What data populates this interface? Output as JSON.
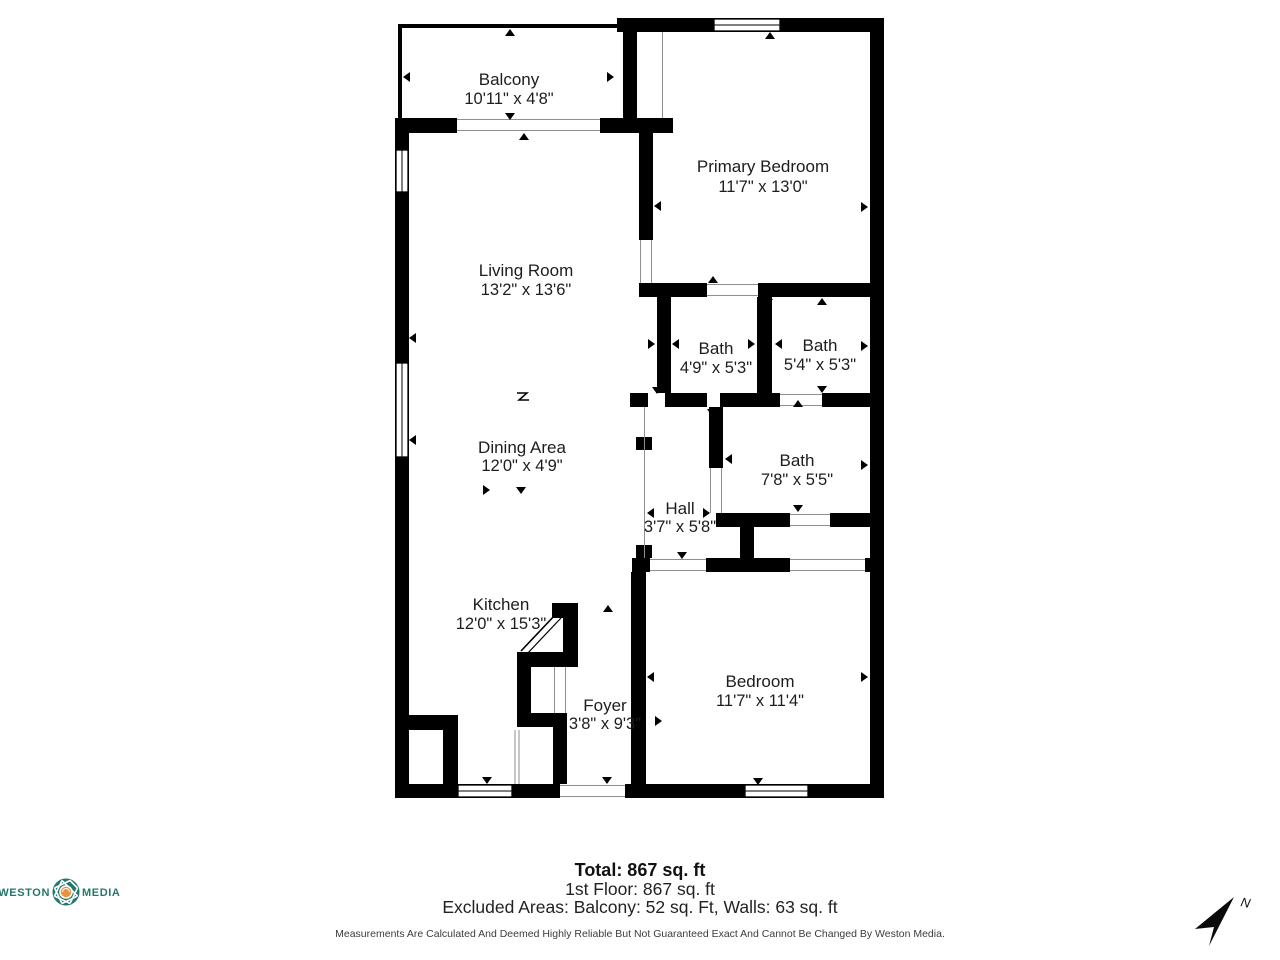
{
  "plan": {
    "rooms": [
      {
        "name": "Balcony",
        "dims": "10'11\" x 4'8\""
      },
      {
        "name": "Primary Bedroom",
        "dims": "11'7\" x 13'0\""
      },
      {
        "name": "Living Room",
        "dims": "13'2\" x 13'6\""
      },
      {
        "name": "Bath",
        "dims": "4'9\" x 5'3\""
      },
      {
        "name": "Bath",
        "dims": "5'4\" x 5'3\""
      },
      {
        "name": "Dining Area",
        "dims": "12'0\" x 4'9\""
      },
      {
        "name": "Bath",
        "dims": "7'8\" x 5'5\""
      },
      {
        "name": "Hall",
        "dims": "3'7\" x 5'8\""
      },
      {
        "name": "Kitchen",
        "dims": "12'0\" x 15'3\""
      },
      {
        "name": "Foyer",
        "dims": "3'8\" x 9'3\""
      },
      {
        "name": "Bedroom",
        "dims": "11'7\" x 11'4\""
      }
    ]
  },
  "footer": {
    "total": "Total: 867 sq. ft",
    "first_floor": "1st Floor: 867 sq. ft",
    "excluded": "Excluded Areas: Balcony: 52 sq. Ft, Walls: 63 sq. ft",
    "disclaimer": "Measurements Are Calculated And Deemed Highly Reliable But Not Guaranteed Exact And Cannot Be Changed By Weston Media."
  },
  "logo": {
    "word_left": "WESTON",
    "word_right": "MEDIA"
  },
  "compass": {
    "north_label": "N"
  },
  "colors": {
    "wall": "#000000",
    "logo_teal": "#24776e",
    "logo_orange": "#e8923f"
  }
}
